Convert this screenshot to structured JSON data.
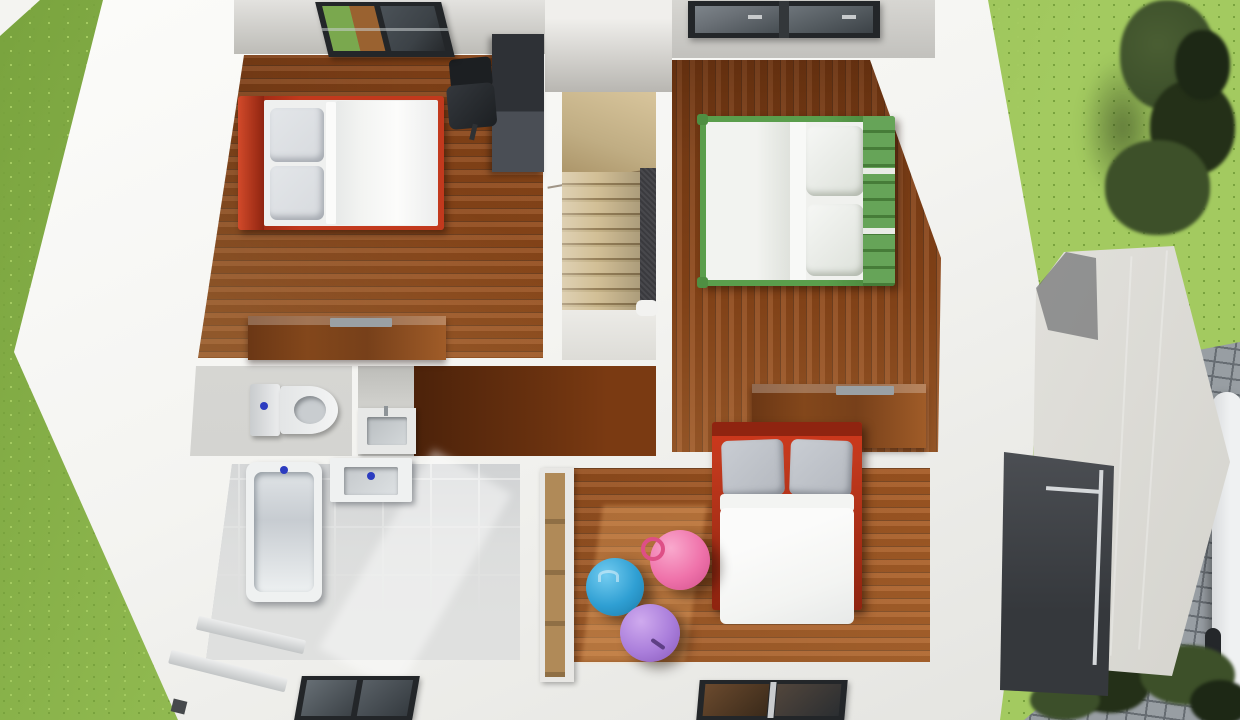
{
  "scene": {
    "type": "3d-floorplan-top-down-cutaway-render",
    "floor": "upper-storey",
    "rooms": [
      {
        "id": "bedroom-1",
        "position": "top-left",
        "flooring": "wood-planks-horizontal",
        "contents": [
          "double-bed-red-frame-white-duvet-two-grey-pillows",
          "dark-desk-unit",
          "black-office-chair",
          "wood-dresser",
          "open-roof-window"
        ]
      },
      {
        "id": "stairwell",
        "position": "top-center",
        "contents": [
          "winder-staircase-beige-steps",
          "dark-stair-void-carpet",
          "white-newel-post"
        ]
      },
      {
        "id": "bedroom-2",
        "position": "top-right",
        "flooring": "wood-planks-vertical",
        "contents": [
          "double-bed-green-slatted-frame-white-bedding-two-pillows",
          "wood-dresser",
          "roof-window-two-panes"
        ]
      },
      {
        "id": "wc",
        "position": "middle-left",
        "flooring": "grey-screed",
        "contents": [
          "toilet-with-cistern-blue-flush-button"
        ]
      },
      {
        "id": "utility-niche",
        "position": "middle-center",
        "contents": [
          "counter-with-inset-sink-and-faucet"
        ]
      },
      {
        "id": "hallway",
        "position": "center",
        "flooring": "wood-planks-horizontal-shadowed",
        "contents": []
      },
      {
        "id": "bathroom",
        "position": "bottom-left",
        "flooring": "grey-tiles-with-white-grout",
        "contents": [
          "bathtub-blue-faucet-dot",
          "washbasin-blue-faucet-dot",
          "roof-window",
          "diagonal-baseboard-ledges"
        ]
      },
      {
        "id": "bedroom-3",
        "position": "bottom-right",
        "flooring": "wood-planks-horizontal",
        "contents": [
          "double-bed-red-frame-two-grey-pillows-white-duvet",
          "built-in-wardrobe-tan-panels",
          "hopper-ball-blue",
          "hopper-ball-pink",
          "hopper-ball-purple",
          "roof-window",
          "sunlight-patch"
        ]
      }
    ],
    "exterior": [
      "grass-lawn-left",
      "grass-lawn-top-right",
      "tree-top-right",
      "shrubs-bottom-right",
      "cobblestone-path-right-edge",
      "white-car-partially-visible-right-edge",
      "annex-with-sloped-white-roof-and-dark-terrace-recess",
      "glass-terrace-railing",
      "neighbour-wall-fragment-top-left-corner"
    ],
    "counts": {
      "bedrooms": 3,
      "roof_windows": 4,
      "exercise_balls": 3
    }
  },
  "palette": {
    "grass": "#8fb84f",
    "grassDark": "#79a33e",
    "grassLight": "#a3ca60",
    "pave": "#989ea3",
    "paveLine": "#666c72",
    "wall": "#f4f4f1",
    "wallShade": "#e2e2de",
    "ceil": "#d7d6d2",
    "ceilDark": "#bdbcb7",
    "wood": "#8d4719",
    "woodDark": "#4f2408",
    "woodLight": "#c17a36",
    "woodHall": "#7a3a12",
    "stair": "#c0ad83",
    "stairLine": "#97815a",
    "stairVoid": "#3a3a3e",
    "tile": "#c0c3c7",
    "grout": "#ebedee",
    "bathWhite": "#dfe0df",
    "fixture": "#eff1f1",
    "basin": "#c4c8cb",
    "faucet": "#2c3cc0",
    "bedRed": "#c2391d",
    "bedRedDark": "#8f2410",
    "bedGreen": "#5a9e4c",
    "bedGreenDark": "#447f36",
    "duvet": "#f3f4f2",
    "pillow": "#d7dade",
    "pillowDark": "#b4b8bf",
    "desk": "#2e3136",
    "deskLight": "#4a4e55",
    "chairDark": "#1c1f22",
    "dresser": "#83471b",
    "dresserLight": "#a05c28",
    "tray": "#9aa0a4",
    "wardrobe": "#b08a58",
    "ballBlue": "#2f9fd3",
    "ballBlueHi": "#73ccf0",
    "ballPink": "#ef72aa",
    "ballPinkHi": "#f9a9cd",
    "ballPurple": "#aa7edb",
    "ballPurpleHi": "#cfaaee",
    "roof": "#e9e8e4",
    "roofShade": "#88898c",
    "terrace": "#53565b",
    "terraceDark": "#35383c",
    "glass": "#3c4247",
    "glassLight": "#6a7076",
    "frame": "#232629",
    "tree": "#3c4f2a",
    "treeDark": "#243018",
    "car": "#eff1f2"
  }
}
